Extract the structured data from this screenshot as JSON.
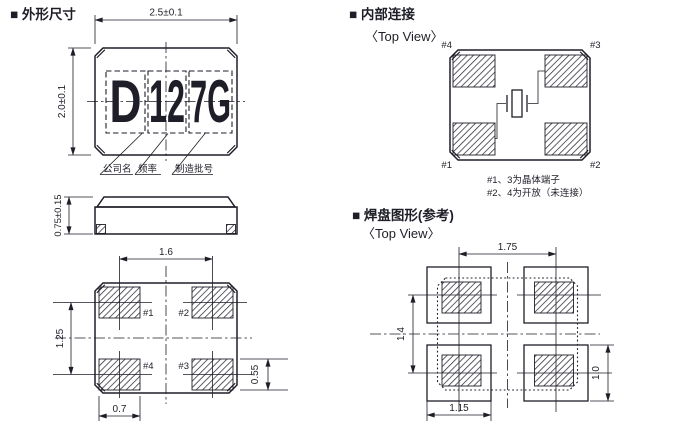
{
  "colors": {
    "ink": "#1e1e28",
    "background": "#ffffff"
  },
  "sections": {
    "outline": {
      "title": "■ 外形尺寸"
    },
    "internal": {
      "title": "■ 内部连接",
      "subtitle": "〈Top View〉"
    },
    "land": {
      "title": "■ 焊盘图形(参考)",
      "subtitle": "〈Top View〉"
    }
  },
  "outline": {
    "top": {
      "dim_width": "2.5±0.1",
      "dim_height": "2.0±0.1",
      "marking": [
        "D",
        "12",
        "7G"
      ],
      "callouts": [
        "公司名",
        "频率",
        "制造批号"
      ]
    },
    "side": {
      "dim_thickness": "0.75±0.15"
    },
    "bottom": {
      "dim_pitch_x": "1.6",
      "dim_pitch_y": "1.25",
      "dim_pad_w": "0.7",
      "dim_pad_h": "0.55",
      "pads": {
        "tl": "#1",
        "tr": "#2",
        "bl": "#4",
        "br": "#3"
      }
    }
  },
  "internal": {
    "pads": {
      "tl": "#4",
      "tr": "#3",
      "bl": "#1",
      "br": "#2"
    },
    "notes": [
      "#1、3为晶体端子",
      "#2、4为开放（未连接）"
    ]
  },
  "land": {
    "dim_pitch_x": "1.75",
    "dim_pitch_y": "1.4",
    "dim_pad_w": "1.15",
    "dim_pad_h": "1.0"
  }
}
